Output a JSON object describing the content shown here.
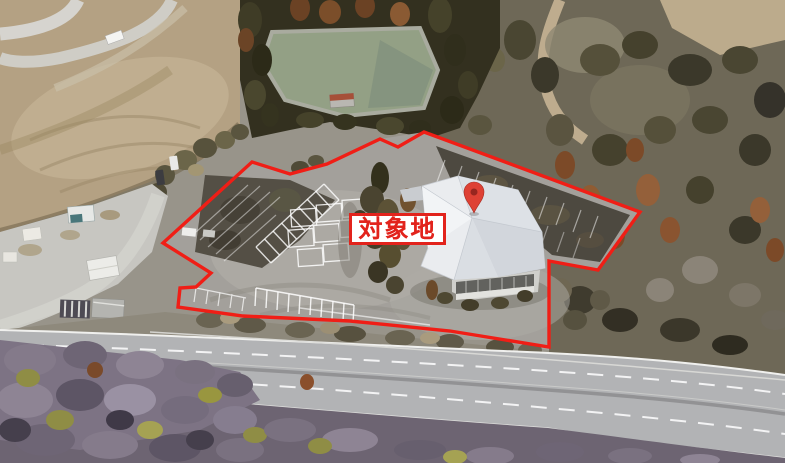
{
  "scene": {
    "type": "oblique-aerial-satellite-photo",
    "description": "Winter aerial view of a roadside property: large parking lot and white-roofed building outlined in red, bordered by forest, bare construction earth, a pond, and a curving highway",
    "features": [
      "bare-earth-construction-area",
      "forest-with-retention-pond",
      "parking-lot-with-stall-markings",
      "white-roofed-building",
      "access-road-with-sheds",
      "highway",
      "winter-tree-canopy"
    ],
    "palette": {
      "asphalt": "#a3a09b",
      "old_lot_dark": "#544f45",
      "dirt": "#b4a183",
      "forest_dark": "#33301f",
      "conifer_rust": "#7c4a28",
      "pond": "#93a085",
      "roof_white": "#eaecef",
      "highway": "#b2b3b5",
      "canopy_purple": "#857b8b",
      "canopy_olive": "#8f8d45"
    }
  },
  "annotations": {
    "site_label": {
      "text": "対象地",
      "text_color": "#e2231c",
      "background_color": "#ffffff",
      "border_color": "#e2231c"
    },
    "boundary": {
      "color": "#f01e16",
      "stroke_width": "3.4",
      "points": "252,162 290,174 327,164 380,139 398,147 424,132 640,212 598,270 549,261 549,347 450,331 350,321 243,316 178,307 180,288 196,287 211,273 163,243"
    },
    "location_pin": {
      "icon": "location-pin-icon",
      "color": "#de4134",
      "hole_color": "#97261f",
      "tip_x": 474,
      "tip_y": 213
    }
  }
}
